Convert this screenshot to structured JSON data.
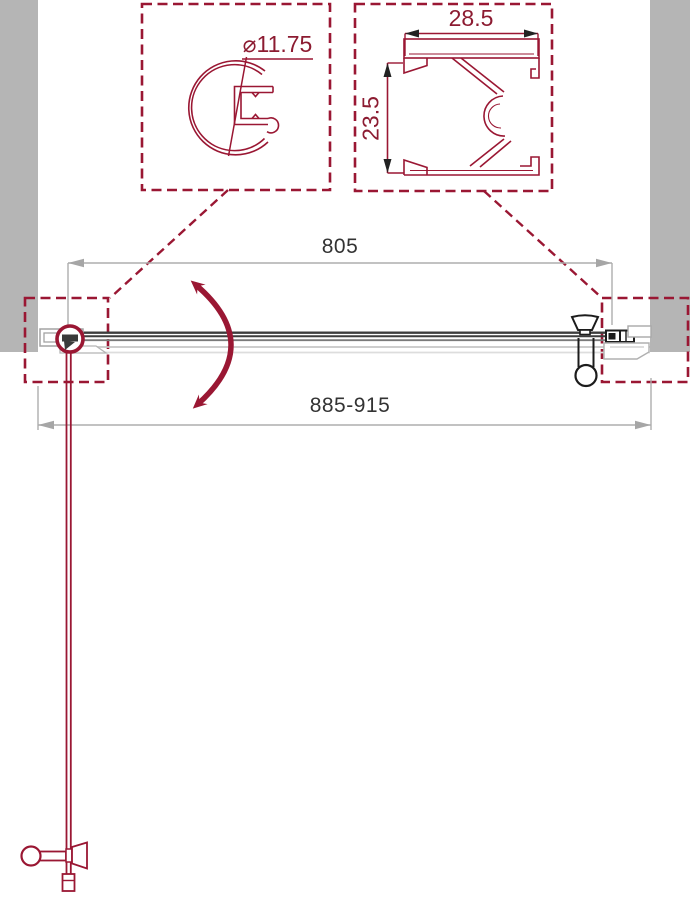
{
  "diagram": {
    "dimensions": {
      "glass_width": "805",
      "overall_width_range": "885-915",
      "profile_diameter": "⌀11.75",
      "wall_profile_width": "28.5",
      "wall_profile_depth": "23.5"
    },
    "colors": {
      "brand_red": "#9a1733",
      "detail_text_red": "#8c1b31",
      "glass_line_dark": "#3d3d3d",
      "wall_gray": "#b5b5b5",
      "bracket_gray": "#a8a8a8",
      "dimension_gray": "#adadad",
      "dimension_text": "#333333",
      "hardware_black": "#1c1c1c"
    }
  }
}
